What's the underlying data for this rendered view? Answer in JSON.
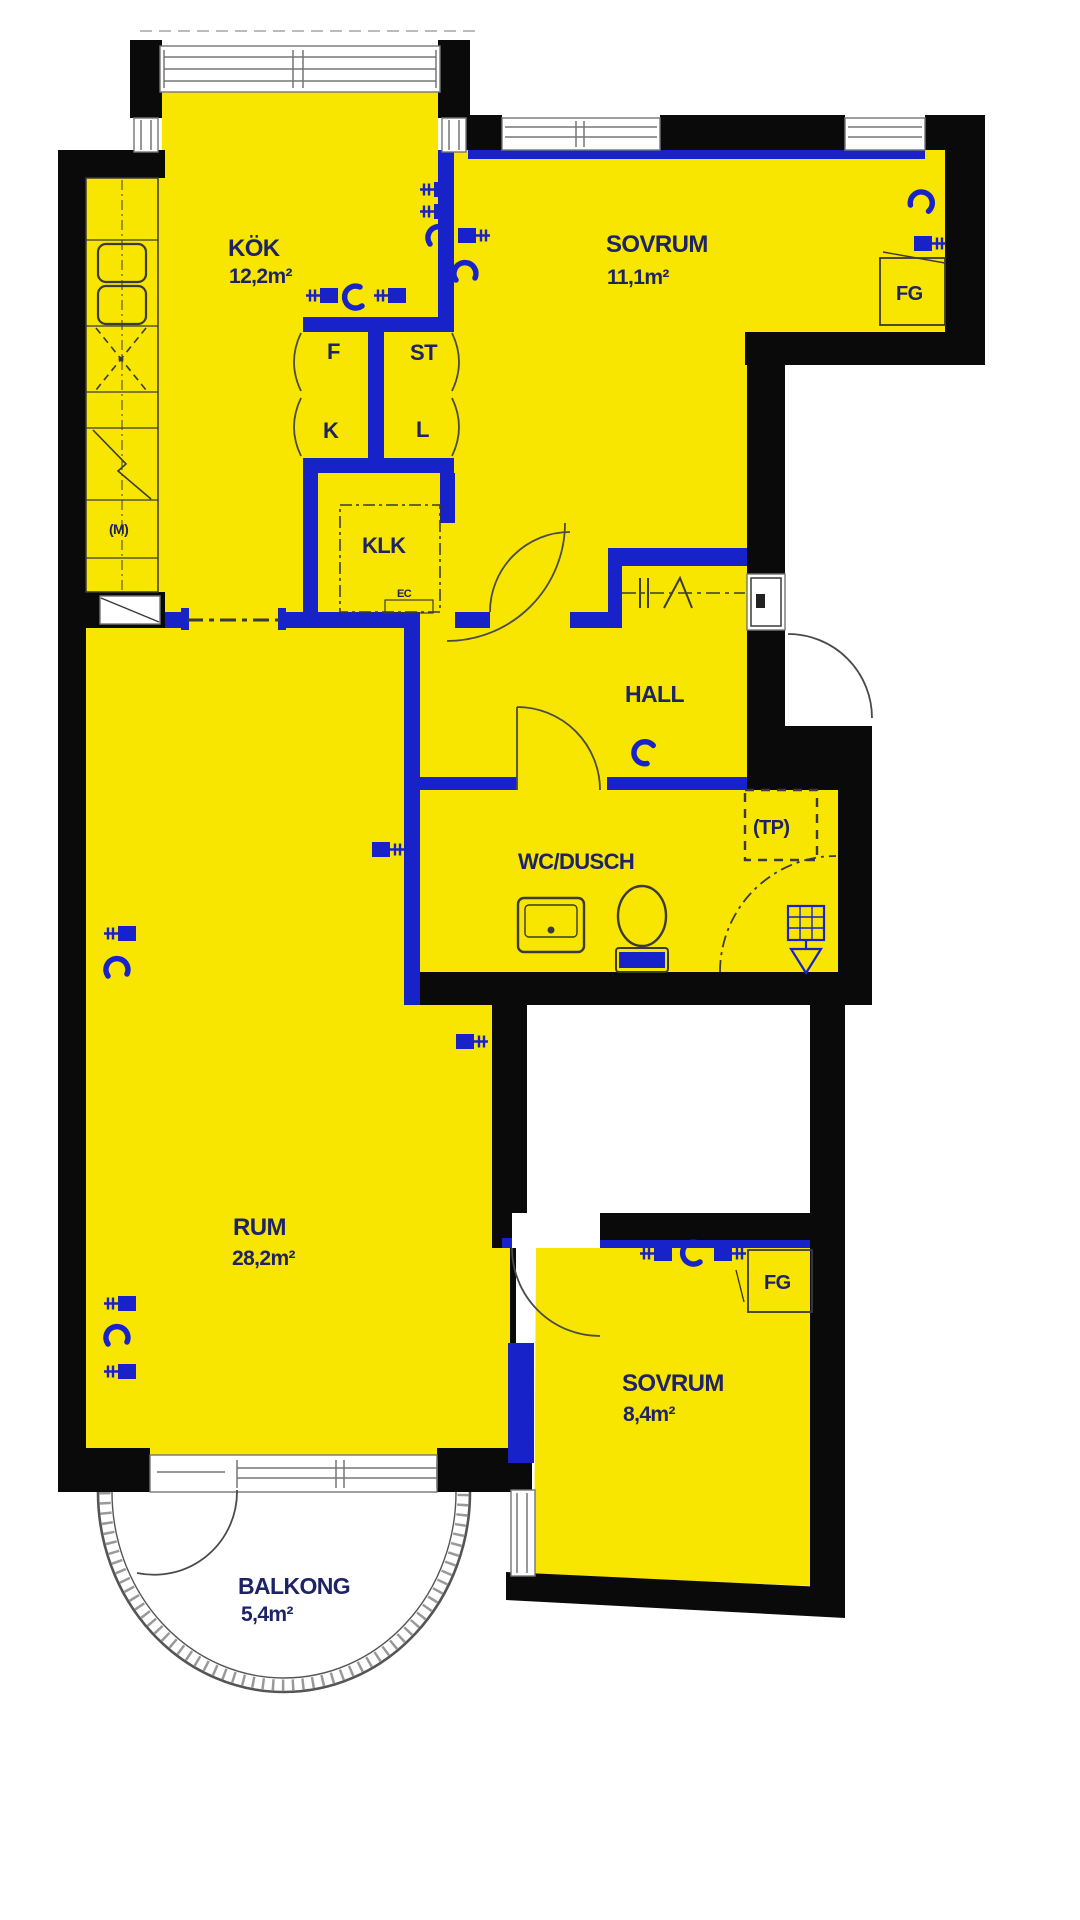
{
  "page": {
    "title": "Apartment floor plan",
    "background": "#ffffff"
  },
  "colors": {
    "room-fill": "#F8E500",
    "wall": "#0a0a0a",
    "partition": "#1722C8",
    "label": "#1d2365",
    "fixture": "#3a3a3a",
    "window": "#767676",
    "balcony": "#6a6a6a"
  },
  "rooms": {
    "kok": {
      "name": "KÖK",
      "area": "12,2m²"
    },
    "sovrum_stor": {
      "name": "SOVRUM",
      "area": "11,1m²"
    },
    "sovrum_liten": {
      "name": "SOVRUM",
      "area": "8,4m²"
    },
    "rum": {
      "name": "RUM",
      "area": "28,2m²"
    },
    "hall": {
      "name": "HALL"
    },
    "wc_dusch": {
      "name": "WC/DUSCH"
    },
    "klk": {
      "name": "KLK"
    },
    "balkong": {
      "name": "BALKONG",
      "area": "5,4m²"
    }
  },
  "closets": {
    "f": "F",
    "st": "ST",
    "k": "K",
    "l": "L",
    "fg_top": "FG",
    "fg_bottom": "FG"
  },
  "annotations": {
    "tp": "(TP)",
    "m": "(M)",
    "el": "EC"
  },
  "icons": [
    "sink-icon",
    "stove-icon",
    "washbasin-icon",
    "toilet-icon",
    "floor-drain-icon",
    "shower-corner-icon",
    "radiator-valve-icon",
    "heating-pipe-icon",
    "door-swing-icon",
    "window-icon",
    "wardrobe-rail-icon"
  ]
}
